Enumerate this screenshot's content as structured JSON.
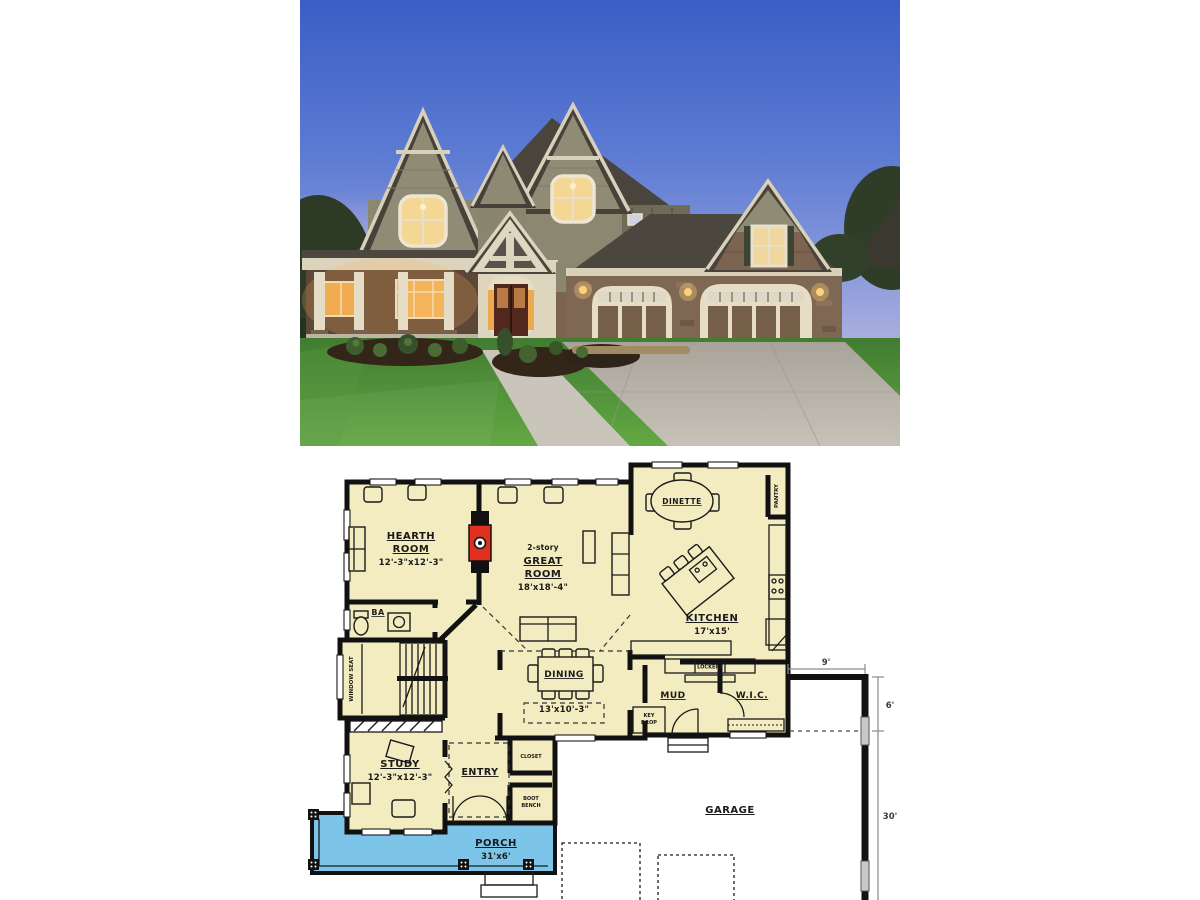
{
  "plan": {
    "rooms": {
      "hearth": {
        "line1": "HEARTH",
        "line2": "ROOM",
        "dims": "12'-3\"x12'-3\""
      },
      "great": {
        "story": "2-story",
        "line1": "GREAT",
        "line2": "ROOM",
        "dims": "18'x18'-4\""
      },
      "dinette": {
        "name": "DINETTE"
      },
      "kitchen": {
        "name": "KITCHEN",
        "dims": "17'x15'"
      },
      "pantry": {
        "name": "PANTRY"
      },
      "ba": {
        "name": "BA"
      },
      "window_seat": {
        "name": "WINDOW SEAT"
      },
      "dining": {
        "name": "DINING",
        "dims": "13'x10'-3\""
      },
      "mud": {
        "name": "MUD"
      },
      "lockers": {
        "name": "LOCKERS"
      },
      "key_drop": {
        "line1": "KEY",
        "line2": "DROP"
      },
      "wic": {
        "name": "W.I.C."
      },
      "study": {
        "name": "STUDY",
        "dims": "12'-3\"x12'-3\""
      },
      "entry": {
        "name": "ENTRY"
      },
      "closet": {
        "name": "CLOSET"
      },
      "boot_bench": {
        "line1": "BOOT",
        "line2": "BENCH"
      },
      "porch": {
        "name": "PORCH",
        "dims": "31'x6'"
      },
      "garage": {
        "name": "GARAGE"
      }
    },
    "dimensions": {
      "top": "9'",
      "side_upper": "6'",
      "side_lower": "30'"
    },
    "colors": {
      "room_fill": "#f3ecc0",
      "porch_fill": "#7cc4e8",
      "wall": "#111111",
      "fireplace_red": "#e03020"
    }
  },
  "photo": {
    "colors": {
      "sky_top": "#3a5ec6",
      "sky_horizon_pink": "#e8cdd8",
      "siding": "#8d8973",
      "trim_cream": "#ddd4be",
      "roof": "#49453d",
      "stone": "#7c6450",
      "window_glow": "#f0b45a",
      "lawn": "#4a8a38",
      "driveway": "#b6b2a8",
      "porch_shadow": "#5c4636",
      "garage_door_panel": "#776049"
    }
  }
}
